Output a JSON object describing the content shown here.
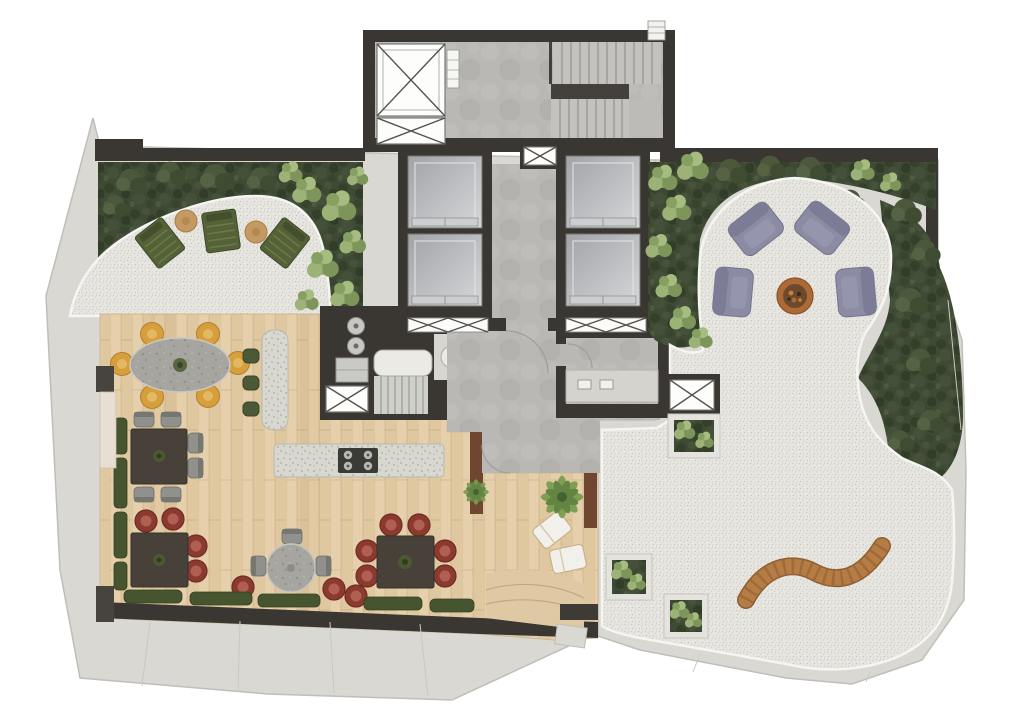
{
  "meta": {
    "type": "architectural-floor-plan",
    "view": "top-down-rendered-plan",
    "level": "rooftop-amenity-terrace"
  },
  "palette": {
    "background": "#ffffff",
    "slab": "#d9d8d3",
    "slab_edge": "#bfbeb8",
    "wall": "#3a3632",
    "concrete": "#b9b8b4",
    "gravel": "#e8e7e2",
    "dark_planting": "#3f4a34",
    "bush": "#8fa768",
    "deck_wood": "#e6d0ab",
    "wood_wall": "#6f4730",
    "terrazzo": "#d8d8d1",
    "stone_table": "#a6a5a0",
    "elevator_cab": "#c0c1c4",
    "chair_mustard": "#d79f3c",
    "chair_red": "#8c3a30",
    "bench_green": "#46552f",
    "lounger_olive": "#556237",
    "armchair_purple": "#8b8ba4",
    "firepit_copper": "#ad6a38",
    "bench_wood": "#b57c44",
    "white_lounger": "#f1f0ea",
    "side_table_tan": "#c59a62",
    "palm_green": "#7a9c50",
    "stool_green": "#4c5936"
  },
  "zones": {
    "core": {
      "name": "circulation-core",
      "features": [
        "stair",
        "elevator-bank-left",
        "elevator-bank-right",
        "shaft-large",
        "shaft-small",
        "service-shaft"
      ]
    },
    "deck": {
      "name": "dining-deck"
    },
    "sun_terrace": {
      "name": "gravel-sun-terrace"
    },
    "fire_lounge": {
      "name": "fire-pit-lounge"
    },
    "zen_terrace": {
      "name": "gravel-garden-terrace"
    }
  },
  "inventory": {
    "sun_loungers_olive": 3,
    "side_tables": 2,
    "oval_dining_table_chairs": 6,
    "square_tables": 3,
    "round_table_chairs": 4,
    "communal_table_chairs": 8,
    "bar_stools": 3,
    "kitchen_island_burners": 4,
    "purple_armchairs": 4,
    "fire_pit": 1,
    "curved_bench": 1,
    "white_loungers": 2,
    "planter_boxes": 3,
    "elevators": 4
  }
}
